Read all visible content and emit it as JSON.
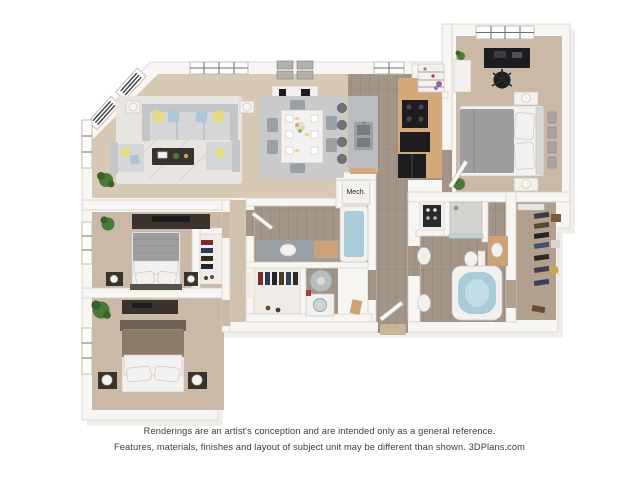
{
  "plan": {
    "mech_label": "Mech.",
    "colors": {
      "page-bg": "#ffffff",
      "wall": "#f8f6f3",
      "wall-line": "#d6d1ca",
      "wall-shadow": "#e4e0da",
      "carpet-main": "#d8c9b6",
      "carpet-bedroom": "#c9b9a6",
      "carpet-hall": "#d0c2af",
      "closet-floor": "#efece8",
      "walkin-floor": "#b2a08f",
      "wood": "#a39588",
      "wood-line": "#8f8276",
      "water": "#a9ccd8",
      "counter-tan": "#d3a97c",
      "cabinet-tan": "#cda276",
      "appliance-black": "#1d1d20",
      "island-gray": "#b9bdc0",
      "metal-gray": "#9aa0a4",
      "sofa-gray": "#d4d6d8",
      "sofa-back": "#c3c6c9",
      "pillow-yellow": "#e5db85",
      "pillow-blue": "#aac6d8",
      "plant-green": "#4a7a3a",
      "plant-dark": "#3a6128",
      "furniture-dark": "#3a322c",
      "rug-light": "#e8e5e0",
      "rug-gray": "#c8cacc",
      "bed-gray": "#9e9ea1",
      "bed-brown": "#8d7b69",
      "headboard-brown": "#6d6156",
      "linen": "#f2f1ef",
      "mat-tan": "#c8b593",
      "text-color": "#3d3d3d"
    }
  },
  "footer": {
    "line1": "Renderings are an artist's conception and are intended only as a general reference.",
    "line2": "Features, materials, finishes and layout of subject unit may be different than shown. 3DPlans.com"
  }
}
